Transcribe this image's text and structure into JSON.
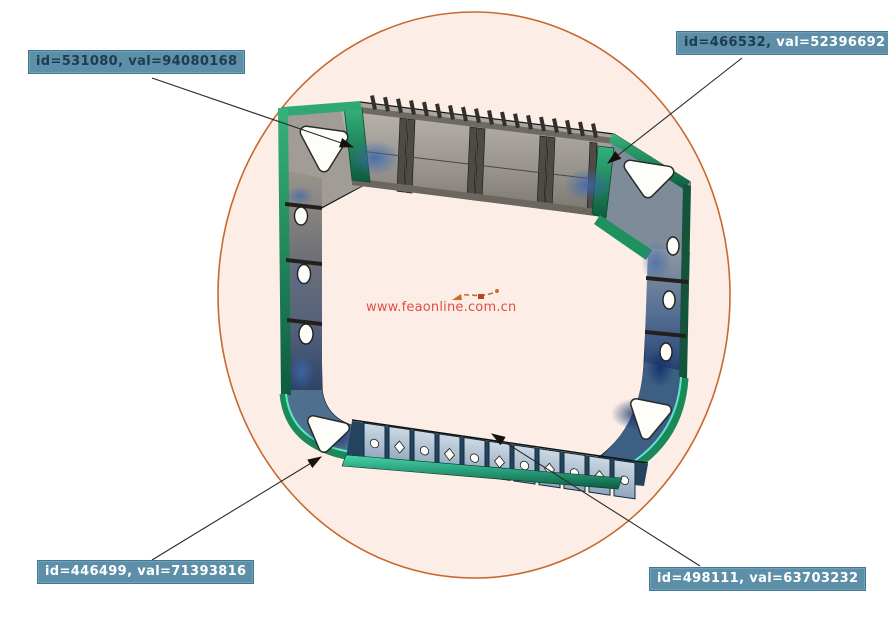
{
  "scene": {
    "description": "FEA stress contour plot of a ship hold frame ring with element annotations",
    "background": "#ffffff",
    "ellipse": {
      "fill": "#fceee6",
      "stroke": "#c9692f"
    }
  },
  "watermark": {
    "text": "www.feaonline.com.cn",
    "color": "#e14f44",
    "doodle_color": "#cc6a2a"
  },
  "annotations": [
    {
      "position": "top-left",
      "id_text": "id=531080,",
      "val_text": "val=94080168",
      "id_color": "#1d3c50",
      "val_color": "#1d3c50",
      "bg_color": "#5d8fa8",
      "border_color": "#3f7a94"
    },
    {
      "position": "top-right",
      "id_text": "id=466532,",
      "val_text": "val=52396692",
      "id_color": "#1d3c50",
      "val_color": "#ffffff",
      "bg_color": "#5d8fa8",
      "border_color": "#3f7a94"
    },
    {
      "position": "bottom-left",
      "id_text": "id=446499,",
      "val_text": "val=71393816",
      "id_color": "#ffffff",
      "val_color": "#ffffff",
      "bg_color": "#5d8fa8",
      "border_color": "#3f7a94"
    },
    {
      "position": "bottom-right",
      "id_text": "id=498111,",
      "val_text": "val=63703232",
      "id_color": "#ffffff",
      "val_color": "#ffffff",
      "bg_color": "#5d8fa8",
      "border_color": "#3f7a94"
    }
  ],
  "model": {
    "colors": {
      "steel_gray": "#95918a",
      "stress_blue": "#3c66ad",
      "deep_blue": "#12306b",
      "edge_green": "#1f8f5f",
      "edge_teal": "#5ce8c8",
      "hole_white": "#fdfdfa",
      "outline": "#15181a",
      "leader_line": "#2a2a26"
    }
  }
}
